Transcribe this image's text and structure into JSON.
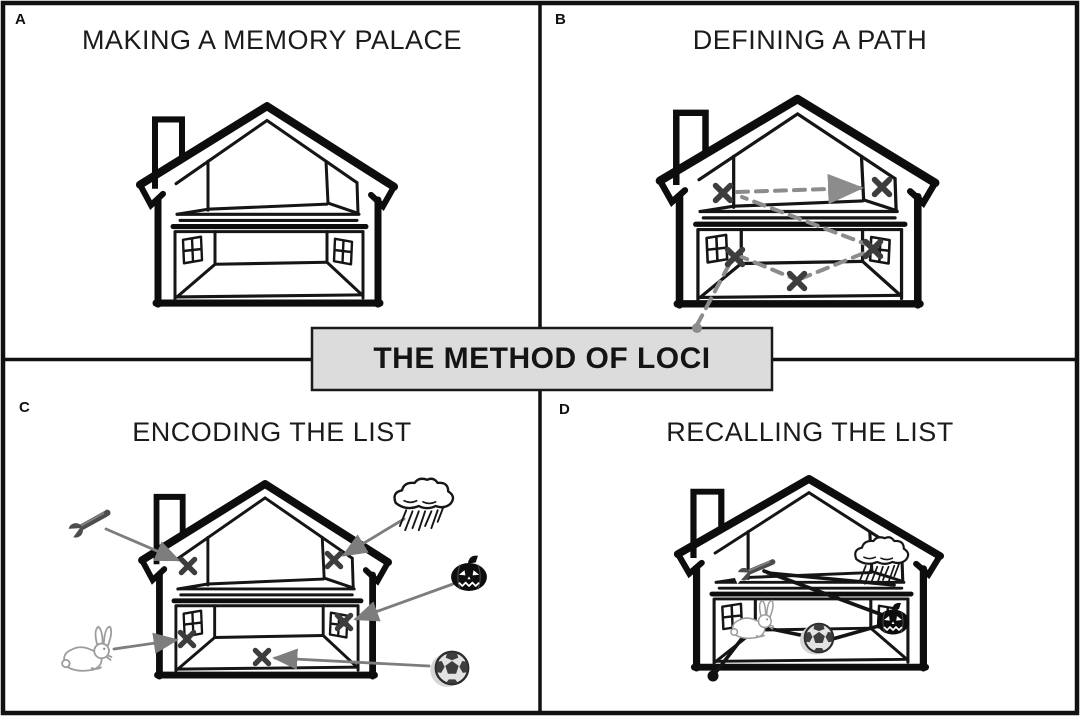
{
  "figure": {
    "center_box": {
      "label": "THE METHOD OF LOCI"
    },
    "panels": [
      {
        "label": "A",
        "title": "MAKING A MEMORY PALACE"
      },
      {
        "label": "B",
        "title": "DEFINING A PATH"
      },
      {
        "label": "C",
        "title": "ENCODING THE LIST"
      },
      {
        "label": "D",
        "title": "RECALLING THE LIST"
      }
    ],
    "icons": {
      "house": "house-cutaway-icon",
      "wrench": "wrench-icon",
      "rain_cloud": "rain-cloud-icon",
      "pumpkin": "pumpkin-icon",
      "rabbit": "rabbit-icon",
      "soccer_ball": "soccer-ball-icon",
      "x_marker": "x-location-marker-icon",
      "start_dot": "path-start-dot-icon",
      "arrow": "encoding-arrow-icon"
    },
    "colors": {
      "background": "#ffffff",
      "ink": "#141414",
      "path_dash_gray": "#8c8c8c",
      "arrow_gray": "#7d7d7d",
      "x_mark_gray": "#3d3d3d",
      "center_box_fill": "#dcdcdc"
    }
  }
}
